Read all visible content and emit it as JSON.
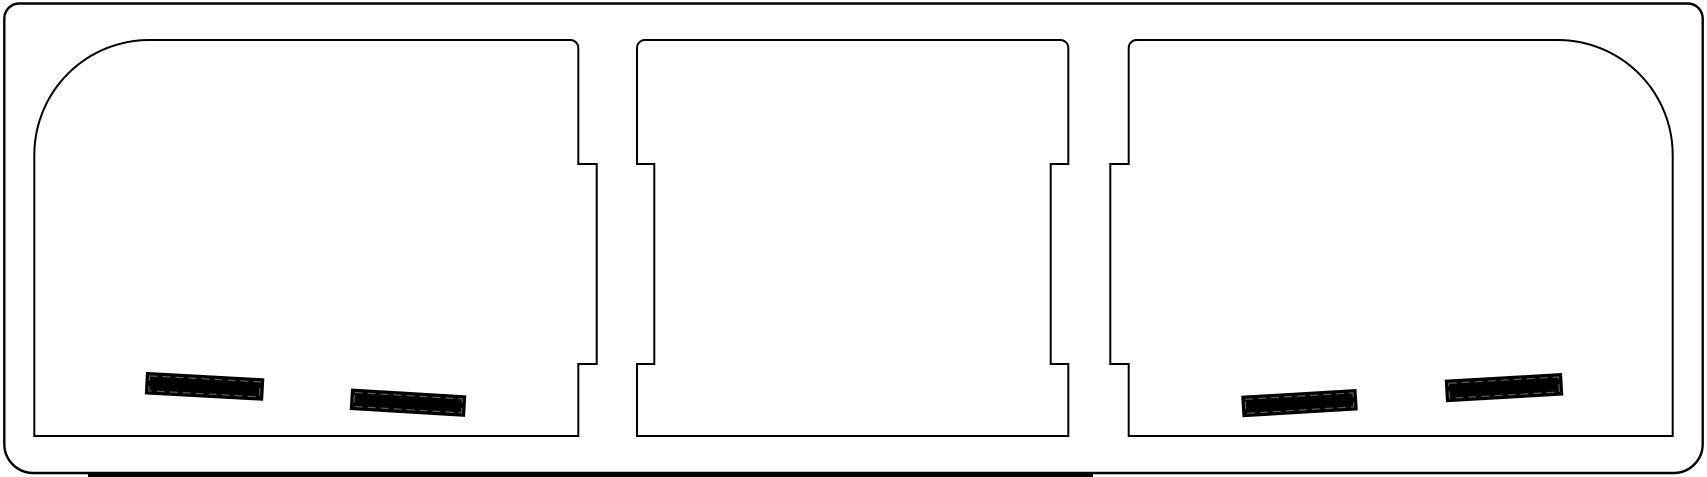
{
  "canvas": {
    "width": 1707,
    "height": 477,
    "background": "#ffffff"
  },
  "drawing": {
    "stroke_color": "#000000",
    "fill_color": "#ffffff",
    "outer_frame": {
      "name": "outer-frame",
      "stroke_width": 2.4,
      "path": "M 19.3 3.5 L 1687.7 3.5 A 15 15 0 0 1 1702.7 18.5 L 1702.7 444 A 29 29 0 0 1 1673.7 473 L 33.3 473 A 29 29 0 0 1 4.3 444 L 4.3 18.5 A 15 15 0 0 1 19.3 3.5 Z"
    },
    "panels": [
      {
        "name": "left-panel",
        "stroke_width": 2,
        "path": "M 34.3 436 L 34.3 155 A 115 115 0 0 1 149.3 40 L 570.3 40 A 8 8 0 0 1 578.3 48 L 578.3 164 L 596.7 164 L 596.7 364 L 578.3 364 L 578.3 436 Z"
      },
      {
        "name": "middle-panel",
        "stroke_width": 2,
        "path": "M 637 436 L 637 364 L 654.3 364 L 654.3 164 L 637 164 L 637 48 A 8 8 0 0 1 645 40 L 1060.3 40 A 8 8 0 0 1 1068.3 48 L 1068.3 164 L 1050.7 164 L 1050.7 364 L 1068.3 364 L 1068.3 436 Z"
      },
      {
        "name": "right-panel",
        "stroke_width": 2,
        "path": "M 1672.7 436 L 1128.7 436 L 1128.7 364 L 1110.3 364 L 1110.3 164 L 1128.7 164 L 1128.7 48 A 8 8 0 0 1 1136.7 40 L 1557.7 40 A 115 115 0 0 1 1672.7 155 Z"
      }
    ],
    "slots": {
      "fill": "#000000",
      "outline_width": 1.5,
      "dash_color": "#5f5f5f",
      "dash_pattern": "8 5",
      "dash_inset": 3,
      "items": [
        {
          "name": "left-panel-slot-1",
          "x": 146.7,
          "y": 372.7,
          "length": 117,
          "height": 21,
          "angle": 3.1
        },
        {
          "name": "left-panel-slot-2",
          "x": 351.7,
          "y": 389.3,
          "length": 114,
          "height": 20,
          "angle": 3.4
        },
        {
          "name": "right-panel-slot-1",
          "x": 1242.0,
          "y": 396.5,
          "length": 114,
          "height": 20,
          "angle": -3.4
        },
        {
          "name": "right-panel-slot-2",
          "x": 1445.5,
          "y": 380.5,
          "length": 116,
          "height": 21,
          "angle": -3.3
        }
      ]
    },
    "partial_bar": {
      "name": "bottom-partial-bar",
      "x": 88,
      "y": 474,
      "width": 1005,
      "height": 6,
      "fill": "#000000"
    }
  }
}
